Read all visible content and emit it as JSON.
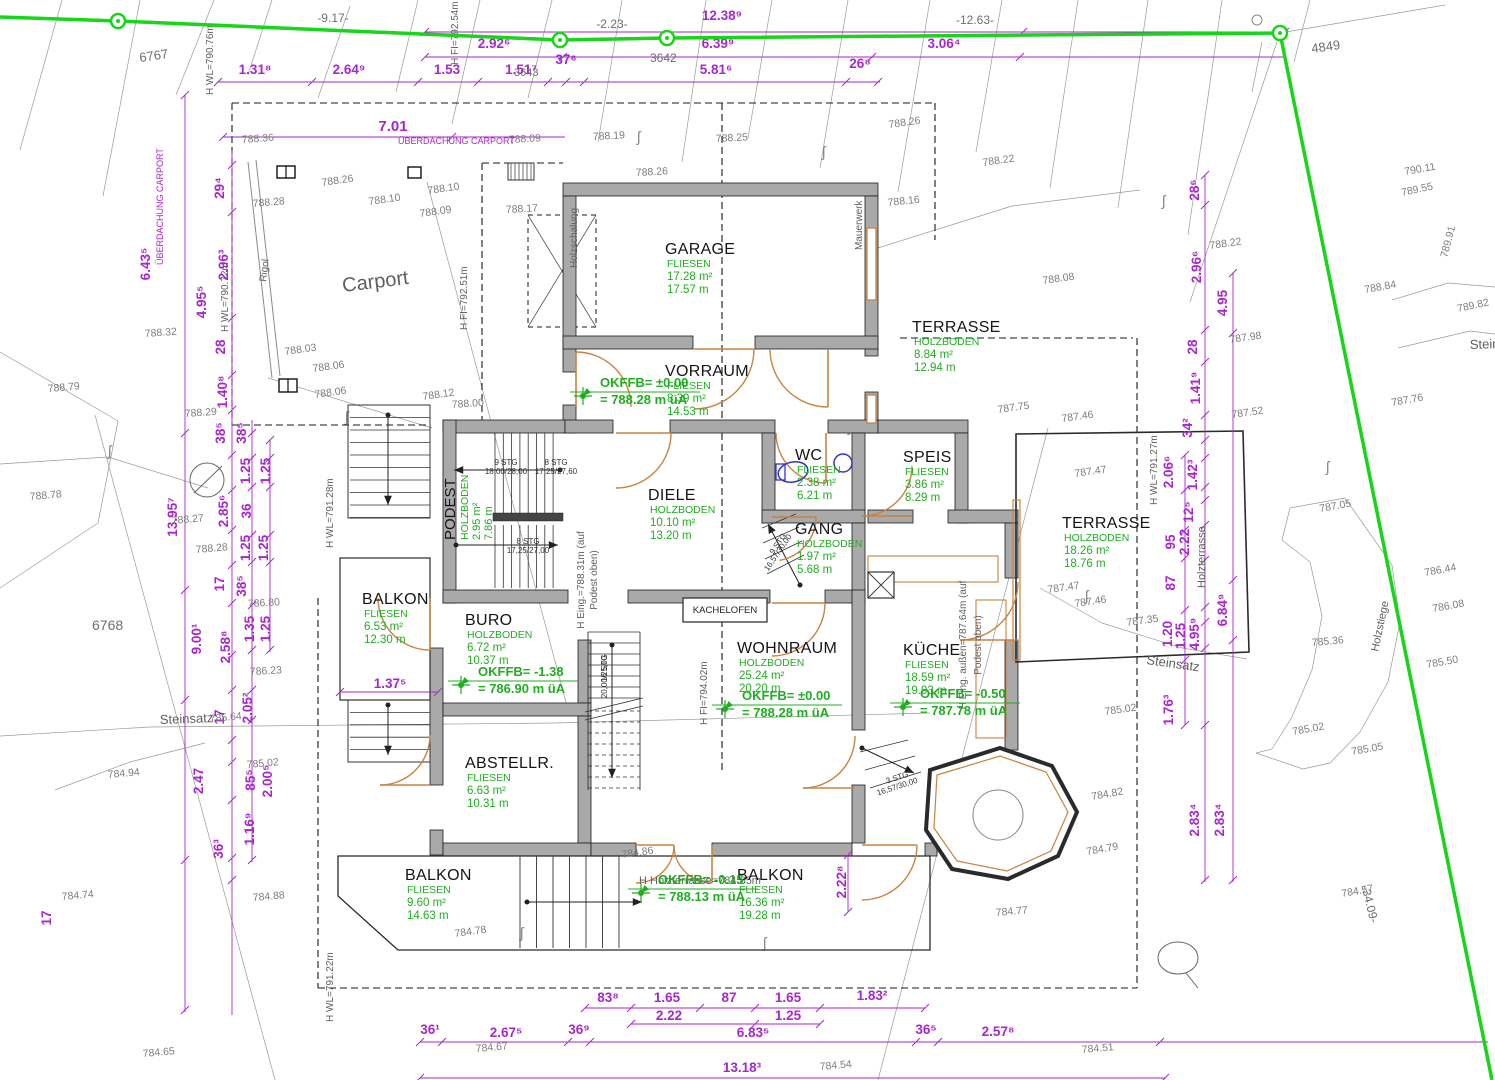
{
  "colors": {
    "wall": "#a9a9a9",
    "wallEdge": "#1c1c1c",
    "boundary": "#17d517",
    "dim": "#a826cf",
    "green": "#1fae1f",
    "door": "#c8833f",
    "contour": "#7d7d7d",
    "fixture": "#3434c8",
    "thin": "#9a9a9a"
  },
  "rooms": [
    {
      "name": "GARAGE",
      "floor": "FLIESEN",
      "area": "17.28 m²",
      "perimeter": "17.57 m",
      "x": 665,
      "y": 254
    },
    {
      "name": "VORRAUM",
      "floor": "FLIESEN",
      "area": "8.39 m²",
      "perimeter": "14.53 m",
      "x": 665,
      "y": 376
    },
    {
      "name": "TERRASSE",
      "floor": "HOLZBODEN",
      "area": "8.84 m²",
      "perimeter": "12.94 m",
      "x": 912,
      "y": 332
    },
    {
      "name": "DIELE",
      "floor": "HOLZBODEN",
      "area": "10.10 m²",
      "perimeter": "13.20 m",
      "x": 648,
      "y": 500
    },
    {
      "name": "WC",
      "floor": "FLIESEN",
      "area": "2.38 m²",
      "perimeter": "6.21 m",
      "x": 795,
      "y": 460
    },
    {
      "name": "SPEIS",
      "floor": "FLIESEN",
      "area": "3.86 m²",
      "perimeter": "8.29 m",
      "x": 903,
      "y": 462
    },
    {
      "name": "GANG",
      "floor": "HOLZBODEN",
      "area": "1.97 m²",
      "perimeter": "5.68 m",
      "x": 795,
      "y": 534
    },
    {
      "name": "TERRASSE",
      "floor": "HOLZBODEN",
      "area": "18.26 m²",
      "perimeter": "18.76 m",
      "x": 1062,
      "y": 528
    },
    {
      "name": "BALKON",
      "floor": "FLIESEN",
      "area": "6.53 m²",
      "perimeter": "12.30 m",
      "x": 362,
      "y": 604
    },
    {
      "name": "BURO",
      "floor": "HOLZBODEN",
      "area": "6.72 m²",
      "perimeter": "10.37 m",
      "x": 465,
      "y": 625
    },
    {
      "name": "WOHNRAUM",
      "floor": "HOLZBODEN",
      "area": "25.24 m²",
      "perimeter": "20.20 m",
      "x": 737,
      "y": 653
    },
    {
      "name": "KÜCHE",
      "floor": "FLIESEN",
      "area": "18.59 m²",
      "perimeter": "19.93 m",
      "x": 903,
      "y": 655
    },
    {
      "name": "ABSTELLR.",
      "floor": "FLIESEN",
      "area": "6.63 m²",
      "perimeter": "10.31 m",
      "x": 465,
      "y": 768
    },
    {
      "name": "BALKON",
      "floor": "FLIESEN",
      "area": "9.60 m²",
      "perimeter": "14.63 m",
      "x": 405,
      "y": 880
    },
    {
      "name": "BALKON",
      "floor": "FLIESEN",
      "area": "16.36 m²",
      "perimeter": "19.28 m",
      "x": 737,
      "y": 880
    },
    {
      "name": "PODEST",
      "floor": "HOLZBODEN",
      "area": "2.95 m²",
      "perimeter": "7.86 m",
      "x": 455,
      "y": 540,
      "rot": -90
    }
  ],
  "level_marks": [
    {
      "label": "OKFFB= ±0.00",
      "elev": "= 788.28 m üA",
      "x": 600,
      "y": 387
    },
    {
      "label": "OKFFB= -1.38",
      "elev": "= 786.90 m üA",
      "x": 478,
      "y": 676
    },
    {
      "label": "OKFFB= ±0.00",
      "elev": "= 788.28 m üA",
      "x": 742,
      "y": 700
    },
    {
      "label": "OKFFB= -0.50",
      "elev": "= 787.78 m üA",
      "x": 920,
      "y": 698
    },
    {
      "label": "OKFFB= -0.15",
      "elev": "= 788.13 m üA",
      "x": 658,
      "y": 884
    }
  ],
  "dimensions": [
    {
      "t": "12.38⁹",
      "x": 722,
      "y": 20
    },
    {
      "t": "2.92⁶",
      "x": 494,
      "y": 48
    },
    {
      "t": "6.39⁹",
      "x": 718,
      "y": 48
    },
    {
      "t": "3.06⁴",
      "x": 944,
      "y": 48
    },
    {
      "t": "1.31⁸",
      "x": 255,
      "y": 74
    },
    {
      "t": "2.64⁹",
      "x": 349,
      "y": 74
    },
    {
      "t": "1.53",
      "x": 447,
      "y": 74
    },
    {
      "t": "1.51⁷",
      "x": 521,
      "y": 74
    },
    {
      "t": "37⁶",
      "x": 566,
      "y": 64
    },
    {
      "t": "5.81⁶",
      "x": 716,
      "y": 74
    },
    {
      "t": "26⁸",
      "x": 860,
      "y": 68
    },
    {
      "t": "7.01",
      "x": 393,
      "y": 131,
      "s": 15
    },
    {
      "t": "83⁸",
      "x": 608,
      "y": 1002
    },
    {
      "t": "1.65",
      "x": 667,
      "y": 1002
    },
    {
      "t": "87",
      "x": 729,
      "y": 1002
    },
    {
      "t": "1.65",
      "x": 788,
      "y": 1002
    },
    {
      "t": "1.83²",
      "x": 872,
      "y": 1000
    },
    {
      "t": "2.22",
      "x": 669,
      "y": 1020
    },
    {
      "t": "1.25",
      "x": 788,
      "y": 1020
    },
    {
      "t": "36¹",
      "x": 430,
      "y": 1034
    },
    {
      "t": "2.67⁵",
      "x": 506,
      "y": 1037
    },
    {
      "t": "36⁹",
      "x": 579,
      "y": 1034
    },
    {
      "t": "6.83⁵",
      "x": 753,
      "y": 1037
    },
    {
      "t": "36⁵",
      "x": 926,
      "y": 1034
    },
    {
      "t": "2.57⁸",
      "x": 998,
      "y": 1036
    },
    {
      "t": "13.18³",
      "x": 742,
      "y": 1072
    },
    {
      "t": "29⁴",
      "x": 224,
      "y": 188,
      "r": -90
    },
    {
      "t": "2.96³",
      "x": 228,
      "y": 265,
      "r": -90
    },
    {
      "t": "28",
      "x": 225,
      "y": 347,
      "r": -90
    },
    {
      "t": "1.40⁸",
      "x": 227,
      "y": 392,
      "r": -90
    },
    {
      "t": "6.43⁵",
      "x": 150,
      "y": 264,
      "r": -90
    },
    {
      "t": "4.95⁵",
      "x": 206,
      "y": 302,
      "r": -90
    },
    {
      "t": "38⁵",
      "x": 225,
      "y": 433,
      "r": -90
    },
    {
      "t": "38⁵",
      "x": 246,
      "y": 433,
      "r": -90
    },
    {
      "t": "1.25",
      "x": 250,
      "y": 471,
      "r": -90
    },
    {
      "t": "1.25",
      "x": 270,
      "y": 471,
      "r": -90
    },
    {
      "t": "2.85⁶",
      "x": 228,
      "y": 511,
      "r": -90
    },
    {
      "t": "36",
      "x": 251,
      "y": 511,
      "r": -90
    },
    {
      "t": "13.95⁷",
      "x": 177,
      "y": 517,
      "r": -90
    },
    {
      "t": "1.25",
      "x": 250,
      "y": 548,
      "r": -90
    },
    {
      "t": "1.25",
      "x": 268,
      "y": 548,
      "r": -90
    },
    {
      "t": "17",
      "x": 224,
      "y": 584,
      "r": -90
    },
    {
      "t": "38⁵",
      "x": 246,
      "y": 586,
      "r": -90
    },
    {
      "t": "1.35",
      "x": 254,
      "y": 629,
      "r": -90
    },
    {
      "t": "1.25",
      "x": 270,
      "y": 629,
      "r": -90
    },
    {
      "t": "9.00¹",
      "x": 201,
      "y": 639,
      "r": -90
    },
    {
      "t": "2.58⁸",
      "x": 230,
      "y": 647,
      "r": -90
    },
    {
      "t": "2.05²",
      "x": 252,
      "y": 708,
      "r": -90
    },
    {
      "t": "17",
      "x": 224,
      "y": 717,
      "r": -90
    },
    {
      "t": "2.47",
      "x": 203,
      "y": 781,
      "r": -90
    },
    {
      "t": "85⁵",
      "x": 255,
      "y": 780,
      "r": -90
    },
    {
      "t": "2.00⁵",
      "x": 272,
      "y": 781,
      "r": -90
    },
    {
      "t": "1.16⁹",
      "x": 254,
      "y": 829,
      "r": -90
    },
    {
      "t": "36³",
      "x": 223,
      "y": 849,
      "r": -90
    },
    {
      "t": "17",
      "x": 51,
      "y": 918,
      "r": -90
    },
    {
      "t": "28⁶",
      "x": 1199,
      "y": 190,
      "r": -90
    },
    {
      "t": "2.96⁶",
      "x": 1201,
      "y": 267,
      "r": -90
    },
    {
      "t": "4.95",
      "x": 1227,
      "y": 303,
      "r": -90
    },
    {
      "t": "28",
      "x": 1197,
      "y": 347,
      "r": -90
    },
    {
      "t": "1.41⁹",
      "x": 1200,
      "y": 388,
      "r": -90
    },
    {
      "t": "34²",
      "x": 1192,
      "y": 428,
      "r": -90
    },
    {
      "t": "2.06⁶",
      "x": 1173,
      "y": 472,
      "r": -90
    },
    {
      "t": "1.42³",
      "x": 1197,
      "y": 475,
      "r": -90
    },
    {
      "t": "12⁵",
      "x": 1193,
      "y": 512,
      "r": -90
    },
    {
      "t": "95",
      "x": 1175,
      "y": 542,
      "r": -90
    },
    {
      "t": "2.22",
      "x": 1189,
      "y": 542,
      "r": -90
    },
    {
      "t": "87",
      "x": 1175,
      "y": 583,
      "r": -90
    },
    {
      "t": "6.84⁹",
      "x": 1227,
      "y": 610,
      "r": -90
    },
    {
      "t": "1.20",
      "x": 1172,
      "y": 634,
      "r": -90
    },
    {
      "t": "1.25",
      "x": 1185,
      "y": 636,
      "r": -90
    },
    {
      "t": "4.95⁹",
      "x": 1199,
      "y": 634,
      "r": -90
    },
    {
      "t": "1.76³",
      "x": 1173,
      "y": 710,
      "r": -90
    },
    {
      "t": "2.83⁴",
      "x": 1199,
      "y": 820,
      "r": -90
    },
    {
      "t": "2.83⁴",
      "x": 1224,
      "y": 820,
      "r": -90
    },
    {
      "t": "1.37⁵",
      "x": 390,
      "y": 688
    },
    {
      "t": "2.22⁸",
      "x": 846,
      "y": 882,
      "r": -90
    }
  ],
  "contours": [
    {
      "t": "788.36",
      "x": 242,
      "y": 143,
      "r": -4
    },
    {
      "t": "788.09",
      "x": 509,
      "y": 143,
      "r": -3
    },
    {
      "t": "788.19",
      "x": 593,
      "y": 140,
      "r": -3
    },
    {
      "t": "788.25",
      "x": 716,
      "y": 142,
      "r": -3
    },
    {
      "t": "788.26",
      "x": 889,
      "y": 128,
      "r": -8
    },
    {
      "t": "788.22",
      "x": 983,
      "y": 166,
      "r": -8
    },
    {
      "t": "788.26",
      "x": 636,
      "y": 176,
      "r": -3
    },
    {
      "t": "788.16",
      "x": 888,
      "y": 206,
      "r": -6
    },
    {
      "t": "788.26",
      "x": 322,
      "y": 186,
      "r": -8
    },
    {
      "t": "788.28",
      "x": 253,
      "y": 207,
      "r": -5
    },
    {
      "t": "788.10",
      "x": 428,
      "y": 194,
      "r": -8
    },
    {
      "t": "788.10",
      "x": 369,
      "y": 205,
      "r": -8
    },
    {
      "t": "788.09",
      "x": 420,
      "y": 217,
      "r": -8
    },
    {
      "t": "788.17",
      "x": 506,
      "y": 213,
      "r": -3
    },
    {
      "t": "788.03",
      "x": 285,
      "y": 355,
      "r": -8
    },
    {
      "t": "788.06",
      "x": 313,
      "y": 372,
      "r": -8
    },
    {
      "t": "788.06",
      "x": 315,
      "y": 398,
      "r": -8
    },
    {
      "t": "788.12",
      "x": 423,
      "y": 400,
      "r": -8
    },
    {
      "t": "788.32",
      "x": 145,
      "y": 337,
      "r": -4
    },
    {
      "t": "788.29",
      "x": 185,
      "y": 417,
      "r": -4
    },
    {
      "t": "788.00",
      "x": 452,
      "y": 408,
      "r": -4
    },
    {
      "t": "788.08",
      "x": 1043,
      "y": 284,
      "r": -8
    },
    {
      "t": "787.75",
      "x": 998,
      "y": 413,
      "r": -8
    },
    {
      "t": "787.46",
      "x": 1062,
      "y": 422,
      "r": -8
    },
    {
      "t": "787.47",
      "x": 1075,
      "y": 477,
      "r": -8
    },
    {
      "t": "787.47",
      "x": 1048,
      "y": 593,
      "r": -8
    },
    {
      "t": "787.46",
      "x": 1075,
      "y": 607,
      "r": -8
    },
    {
      "t": "787.35",
      "x": 1127,
      "y": 626,
      "r": -8
    },
    {
      "t": "787.98",
      "x": 1230,
      "y": 343,
      "r": -8
    },
    {
      "t": "787.52",
      "x": 1232,
      "y": 418,
      "r": -8
    },
    {
      "t": "788.22",
      "x": 1210,
      "y": 249,
      "r": -8
    },
    {
      "t": "788.84",
      "x": 1365,
      "y": 293,
      "r": -10
    },
    {
      "t": "789.82",
      "x": 1458,
      "y": 312,
      "r": -12
    },
    {
      "t": "789.91",
      "x": 1447,
      "y": 258,
      "r": -75
    },
    {
      "t": "790.11",
      "x": 1405,
      "y": 175,
      "r": -10
    },
    {
      "t": "789.55",
      "x": 1402,
      "y": 196,
      "r": -12
    },
    {
      "t": "787.76",
      "x": 1392,
      "y": 406,
      "r": -10
    },
    {
      "t": "787.05",
      "x": 1320,
      "y": 512,
      "r": -10
    },
    {
      "t": "786.44",
      "x": 1425,
      "y": 576,
      "r": -10
    },
    {
      "t": "786.08",
      "x": 1433,
      "y": 612,
      "r": -10
    },
    {
      "t": "785.50",
      "x": 1427,
      "y": 668,
      "r": -10
    },
    {
      "t": "785.36",
      "x": 1312,
      "y": 646,
      "r": -5
    },
    {
      "t": "785.05",
      "x": 1352,
      "y": 755,
      "r": -10
    },
    {
      "t": "785.02",
      "x": 1293,
      "y": 735,
      "r": -10
    },
    {
      "t": "785.02",
      "x": 1105,
      "y": 715,
      "r": -8
    },
    {
      "t": "788.79",
      "x": 48,
      "y": 392,
      "r": -5
    },
    {
      "t": "788.78",
      "x": 30,
      "y": 500,
      "r": -5
    },
    {
      "t": "788.27",
      "x": 172,
      "y": 524,
      "r": -5
    },
    {
      "t": "788.28",
      "x": 196,
      "y": 553,
      "r": -5
    },
    {
      "t": "786.80",
      "x": 248,
      "y": 607,
      "r": -3
    },
    {
      "t": "786.23",
      "x": 250,
      "y": 675,
      "r": -3
    },
    {
      "t": "785.64",
      "x": 210,
      "y": 722,
      "r": -5
    },
    {
      "t": "784.94",
      "x": 108,
      "y": 778,
      "r": -5
    },
    {
      "t": "784.74",
      "x": 62,
      "y": 900,
      "r": -5
    },
    {
      "t": "784.88",
      "x": 253,
      "y": 901,
      "r": -5
    },
    {
      "t": "784.65",
      "x": 143,
      "y": 1057,
      "r": -5
    },
    {
      "t": "785.02",
      "x": 247,
      "y": 768,
      "r": -5
    },
    {
      "t": "784.86",
      "x": 622,
      "y": 858,
      "r": -8
    },
    {
      "t": "784.78",
      "x": 455,
      "y": 937,
      "r": -8
    },
    {
      "t": "784.67",
      "x": 476,
      "y": 1052,
      "r": -5
    },
    {
      "t": "784.54",
      "x": 820,
      "y": 1070,
      "r": -5
    },
    {
      "t": "784.51",
      "x": 1082,
      "y": 1053,
      "r": -5
    },
    {
      "t": "784.82",
      "x": 1092,
      "y": 800,
      "r": -10
    },
    {
      "t": "784.79",
      "x": 1087,
      "y": 855,
      "r": -10
    },
    {
      "t": "784.77",
      "x": 996,
      "y": 916,
      "r": -5
    },
    {
      "t": "784.57",
      "x": 1342,
      "y": 897,
      "r": -10
    }
  ],
  "parcels": [
    {
      "t": "6767",
      "x": 140,
      "y": 62,
      "r": -8,
      "s": 13
    },
    {
      "t": "6768",
      "x": 92,
      "y": 630,
      "s": 14
    },
    {
      "t": "3642",
      "x": 650,
      "y": 62,
      "s": 12
    },
    {
      "t": "3643",
      "x": 514,
      "y": 76,
      "s": 11
    },
    {
      "t": "4849",
      "x": 1312,
      "y": 53,
      "r": -8,
      "s": 13
    }
  ],
  "survey": [
    {
      "t": "-9.17-",
      "x": 333,
      "y": 22
    },
    {
      "t": "-2.23-",
      "x": 612,
      "y": 28
    },
    {
      "t": "-12.63-",
      "x": 975,
      "y": 24
    },
    {
      "t": "-34.09-",
      "x": 1366,
      "y": 905,
      "r": 76
    }
  ],
  "labels": [
    {
      "t": "Carport",
      "x": 343,
      "y": 292,
      "r": -7,
      "s": 20
    },
    {
      "t": "Steinsatz",
      "x": 160,
      "y": 724,
      "r": -2,
      "s": 13
    },
    {
      "t": "Steinsatz",
      "x": 1146,
      "y": 664,
      "r": 8,
      "s": 13
    },
    {
      "t": "Steinsatz",
      "x": 1470,
      "y": 349,
      "r": -2,
      "s": 13
    },
    {
      "t": "Holzterrasse",
      "x": 1205,
      "y": 588,
      "r": -90,
      "s": 11
    },
    {
      "t": "Holzstiege",
      "x": 1378,
      "y": 652,
      "r": -78,
      "s": 11
    },
    {
      "t": "H WL=790.76m",
      "x": 213,
      "y": 95,
      "r": -90,
      "s": 10
    },
    {
      "t": "H WL=790.72m",
      "x": 228,
      "y": 332,
      "r": -90,
      "s": 10
    },
    {
      "t": "H FI=792.54m",
      "x": 458,
      "y": 65,
      "r": -90,
      "s": 10
    },
    {
      "t": "H FI=792.51m",
      "x": 467,
      "y": 330,
      "r": -90,
      "s": 10
    },
    {
      "t": "H WL=791.28m",
      "x": 333,
      "y": 548,
      "r": -90,
      "s": 10
    },
    {
      "t": "H WL=791.27m",
      "x": 1157,
      "y": 505,
      "r": -90,
      "s": 10
    },
    {
      "t": "H WL=791.22m",
      "x": 333,
      "y": 1022,
      "r": -90,
      "s": 10
    },
    {
      "t": "H FI=794.02m",
      "x": 707,
      "y": 725,
      "r": -90,
      "s": 10
    },
    {
      "t": "Holzschalung",
      "x": 577,
      "y": 268,
      "r": -90,
      "s": 10
    },
    {
      "t": "Mauerwerk",
      "x": 862,
      "y": 250,
      "r": -90,
      "s": 10
    },
    {
      "t": "Rigol",
      "x": 266,
      "y": 282,
      "r": -83,
      "s": 10
    },
    {
      "t": "H Eing. außen=787.64m (auf",
      "x": 966,
      "y": 645,
      "r": -90,
      "s": 10,
      "a": "middle"
    },
    {
      "t": "Podest oben)",
      "x": 981,
      "y": 645,
      "r": -90,
      "s": 10,
      "a": "middle"
    },
    {
      "t": "H Eing.=788.31m (auf",
      "x": 584,
      "y": 580,
      "r": -90,
      "s": 10,
      "a": "middle"
    },
    {
      "t": "Podest oben)",
      "x": 597,
      "y": 580,
      "r": -90,
      "s": 10,
      "a": "middle"
    },
    {
      "t": "H Holzterrasse=784.85m",
      "x": 700,
      "y": 884,
      "s": 11,
      "a": "middle"
    }
  ],
  "magenta": [
    {
      "t": "ÜBERDACHUNG CARPORT",
      "x": 398,
      "y": 144,
      "s": 9
    },
    {
      "t": "ÜBERDACHUNG CARPORT",
      "x": 163,
      "y": 265,
      "r": -90,
      "s": 9
    }
  ],
  "stairs": [
    {
      "t1": "9 STG",
      "t2": "18,00/28,00",
      "x": 506,
      "y": 465
    },
    {
      "t1": "8 STG",
      "t2": "17,25/27,60",
      "x": 556,
      "y": 465
    },
    {
      "t1": "8 STG",
      "t2": "17,25/27,00",
      "x": 528,
      "y": 544
    },
    {
      "t1": "9 STG",
      "t2": "16,57/30,00",
      "x": 780,
      "y": 545,
      "r": -56
    },
    {
      "t1": "3 STG",
      "t2": "16,57/30,00",
      "x": 898,
      "y": 780,
      "r": -18
    },
    {
      "t1": "16 STG",
      "t2": "20,00/25,00",
      "x": 607,
      "y": 668,
      "r": -90
    }
  ],
  "kachelofen": "KACHELOFEN"
}
